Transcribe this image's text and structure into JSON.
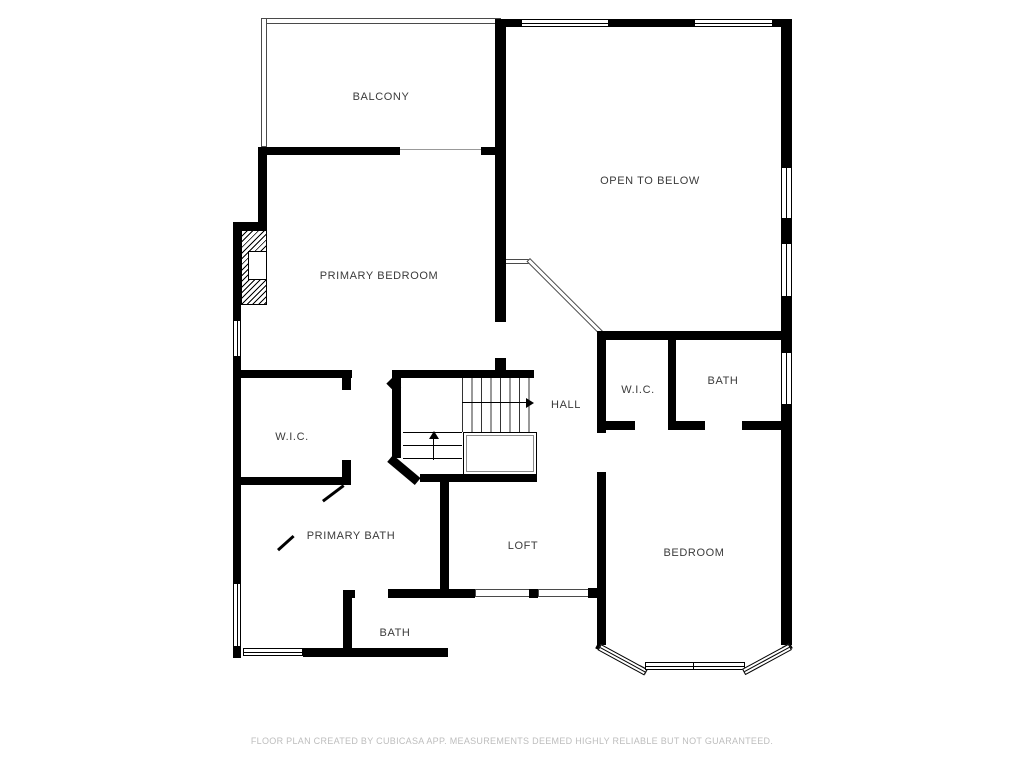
{
  "rooms": {
    "balcony": {
      "label": "BALCONY"
    },
    "open_to_below": {
      "label": "OPEN TO BELOW"
    },
    "primary_bedroom": {
      "label": "PRIMARY BEDROOM"
    },
    "wic_left": {
      "label": "W.I.C."
    },
    "hall": {
      "label": "HALL"
    },
    "wic_right": {
      "label": "W.I.C."
    },
    "bath_upper": {
      "label": "BATH"
    },
    "primary_bath": {
      "label": "PRIMARY BATH"
    },
    "loft": {
      "label": "LOFT"
    },
    "bedroom": {
      "label": "BEDROOM"
    },
    "bath_lower": {
      "label": "BATH"
    }
  },
  "footer": {
    "disclaimer": "FLOOR PLAN CREATED BY CUBICASA APP. MEASUREMENTS DEEMED HIGHLY RELIABLE BUT NOT GUARANTEED."
  },
  "colors": {
    "wall": "#000000",
    "room_label": "#3b3b3b",
    "footer_text": "#bdbdbd",
    "background": "#ffffff"
  }
}
